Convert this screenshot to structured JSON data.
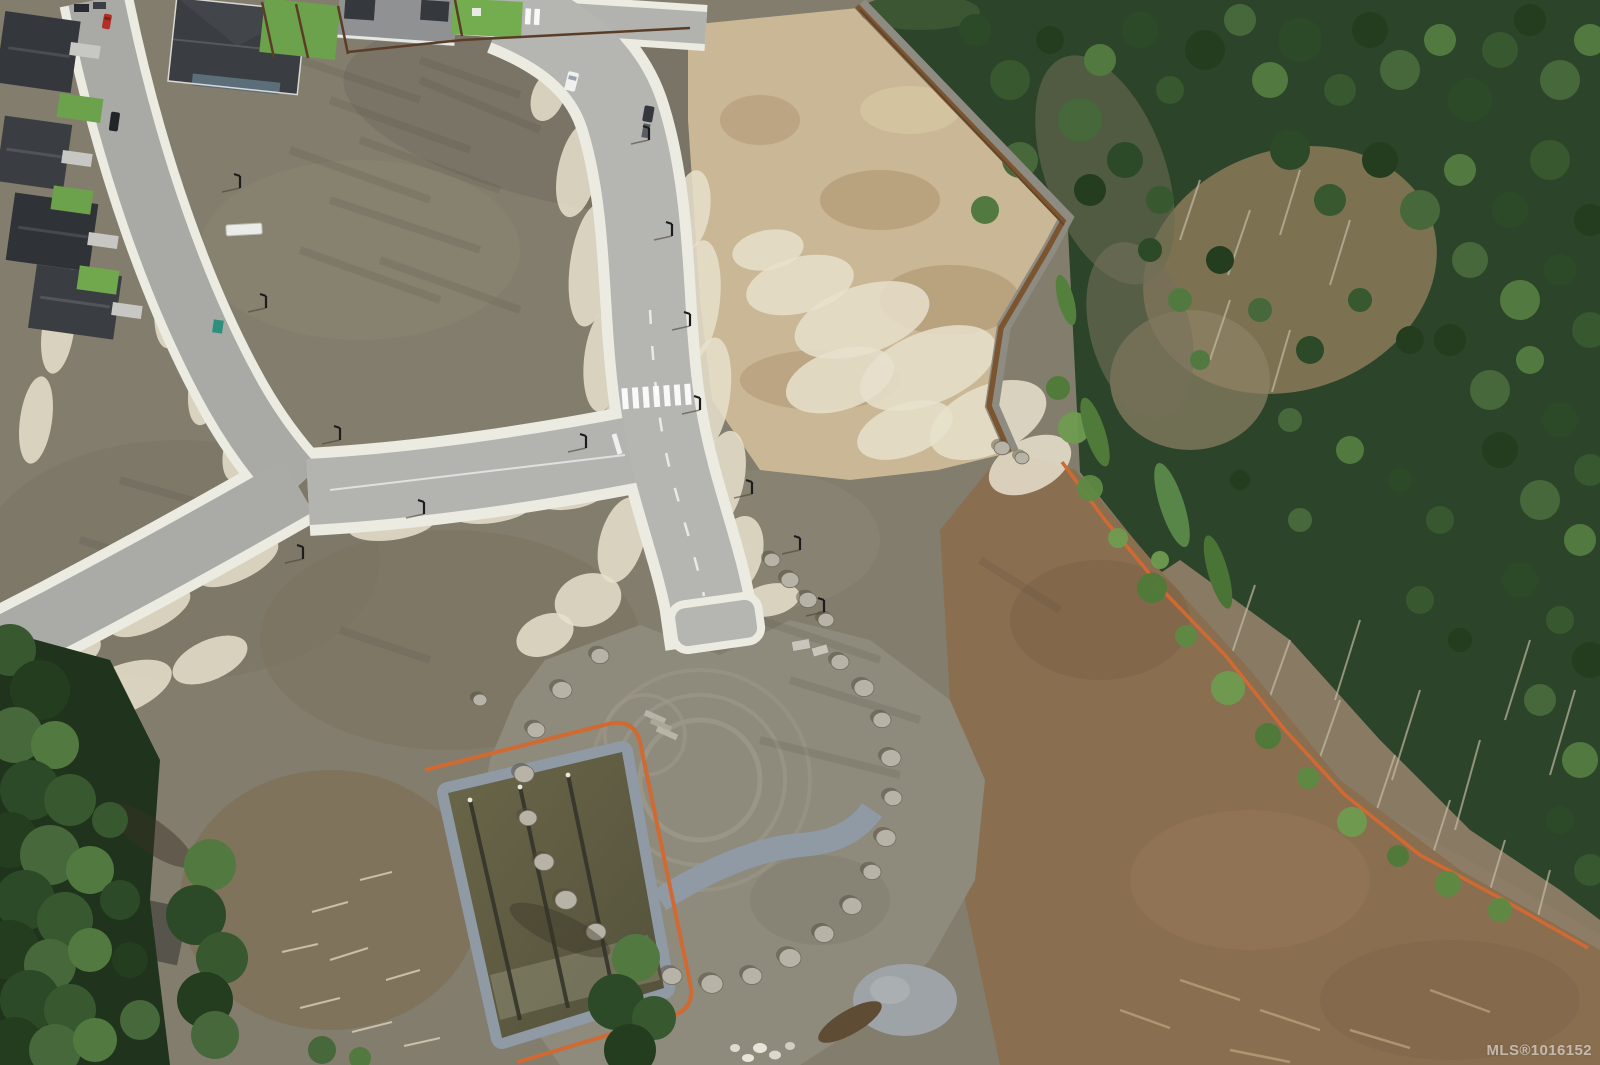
{
  "image": {
    "type": "aerial-drone-photograph",
    "subject": "new residential subdivision under construction beside a forest: graded lots, fresh curbed roads, retention pond, boulder ring, silt fencing",
    "width": 1600,
    "height": 1065
  },
  "watermark": {
    "text": "MLS®1016152"
  },
  "palette": {
    "dirt_olive": "#837d6d",
    "dirt_brown": "#8a6e50",
    "tan_lot": "#c9b795",
    "gravel_white": "#e8e0cd",
    "asphalt_new": "#b5b5b1",
    "asphalt_old": "#a9a9a5",
    "sidewalk": "#ecebe2",
    "forest_green": "#2c452a",
    "tree_green": "#47683a",
    "pond_water": "#5f5c45",
    "riprap_gray": "#8f9aa5",
    "silt_fence_orange": "#cf6a33",
    "retaining_wall_brown": "#7b5530",
    "roof_charcoal": "#3a3d41",
    "lawn_green": "#6da24c",
    "red_car": "#b23026",
    "boulder_gray": "#b7b3a6",
    "pad_gray": "#8e8a7c"
  },
  "features": [
    "existing-neighborhood",
    "new-main-road",
    "t-intersection",
    "crosswalk",
    "cleared-lots",
    "graded-tan-lot",
    "retaining-wall",
    "forest",
    "cleared-slope",
    "silt-fence",
    "gravel-pad",
    "boulder-ring",
    "retention-pond",
    "riprap-channel",
    "mls-watermark"
  ],
  "scenery": {
    "tree_colors": [
      "#2c4a28",
      "#38582f",
      "#243d1f",
      "#47683a",
      "#527a40"
    ],
    "forest_trees": [
      [
        975,
        30,
        16
      ],
      [
        1010,
        80,
        20
      ],
      [
        1050,
        40,
        14
      ],
      [
        1080,
        120,
        22
      ],
      [
        1100,
        60,
        16
      ],
      [
        1140,
        30,
        18
      ],
      [
        1170,
        90,
        14
      ],
      [
        1205,
        50,
        20
      ],
      [
        1240,
        20,
        16
      ],
      [
        1270,
        80,
        18
      ],
      [
        1300,
        40,
        22
      ],
      [
        1340,
        90,
        16
      ],
      [
        1370,
        30,
        18
      ],
      [
        1400,
        70,
        20
      ],
      [
        1440,
        40,
        16
      ],
      [
        1470,
        100,
        22
      ],
      [
        1500,
        50,
        18
      ],
      [
        1530,
        20,
        16
      ],
      [
        1560,
        80,
        20
      ],
      [
        1590,
        40,
        16
      ],
      [
        1125,
        160,
        18
      ],
      [
        1160,
        200,
        14
      ],
      [
        1090,
        190,
        16
      ],
      [
        1020,
        160,
        18
      ],
      [
        985,
        210,
        14
      ],
      [
        1290,
        150,
        20
      ],
      [
        1330,
        200,
        16
      ],
      [
        1380,
        160,
        18
      ],
      [
        1420,
        210,
        20
      ],
      [
        1460,
        170,
        16
      ],
      [
        1510,
        210,
        18
      ],
      [
        1550,
        160,
        20
      ],
      [
        1590,
        220,
        16
      ],
      [
        1470,
        260,
        18
      ],
      [
        1520,
        300,
        20
      ],
      [
        1560,
        270,
        16
      ],
      [
        1590,
        330,
        18
      ],
      [
        1450,
        340,
        16
      ],
      [
        1490,
        390,
        20
      ],
      [
        1530,
        360,
        14
      ],
      [
        1560,
        420,
        18
      ],
      [
        1590,
        470,
        16
      ],
      [
        1500,
        450,
        18
      ],
      [
        1540,
        500,
        20
      ],
      [
        1580,
        540,
        16
      ],
      [
        1520,
        580,
        18
      ],
      [
        1560,
        620,
        14
      ],
      [
        1590,
        660,
        18
      ],
      [
        1540,
        700,
        16
      ],
      [
        1580,
        760,
        18
      ],
      [
        1560,
        820,
        14
      ],
      [
        1590,
        870,
        16
      ],
      [
        1220,
        260,
        14
      ],
      [
        1260,
        310,
        12
      ],
      [
        1200,
        360,
        10
      ],
      [
        1310,
        350,
        14
      ],
      [
        1360,
        300,
        12
      ],
      [
        1410,
        340,
        14
      ],
      [
        1290,
        420,
        12
      ],
      [
        1350,
        450,
        14
      ],
      [
        1400,
        480,
        12
      ],
      [
        1440,
        520,
        14
      ],
      [
        1240,
        480,
        10
      ],
      [
        1300,
        520,
        12
      ],
      [
        1180,
        300,
        12
      ],
      [
        1150,
        250,
        12
      ],
      [
        1420,
        600,
        14
      ],
      [
        1460,
        640,
        12
      ]
    ],
    "sapling_colors": [
      "#5d8a42",
      "#6f9b50",
      "#4e7a39"
    ],
    "saplings": [
      [
        1090,
        488,
        13
      ],
      [
        1118,
        538,
        10
      ],
      [
        1152,
        588,
        15
      ],
      [
        1186,
        636,
        11
      ],
      [
        1228,
        688,
        17
      ],
      [
        1268,
        736,
        13
      ],
      [
        1308,
        778,
        11
      ],
      [
        1352,
        822,
        15
      ],
      [
        1398,
        856,
        11
      ],
      [
        1448,
        884,
        13
      ],
      [
        1074,
        428,
        16
      ],
      [
        1058,
        388,
        12
      ],
      [
        1500,
        910,
        12
      ],
      [
        1160,
        560,
        9
      ]
    ],
    "corner_trees": [
      [
        10,
        650,
        26
      ],
      [
        40,
        690,
        30
      ],
      [
        15,
        735,
        28
      ],
      [
        55,
        745,
        24
      ],
      [
        30,
        790,
        30
      ],
      [
        70,
        800,
        26
      ],
      [
        10,
        840,
        28
      ],
      [
        50,
        855,
        30
      ],
      [
        90,
        870,
        24
      ],
      [
        25,
        900,
        30
      ],
      [
        65,
        920,
        28
      ],
      [
        10,
        950,
        30
      ],
      [
        50,
        965,
        26
      ],
      [
        90,
        950,
        22
      ],
      [
        30,
        1000,
        30
      ],
      [
        70,
        1010,
        26
      ],
      [
        15,
        1045,
        28
      ],
      [
        55,
        1050,
        26
      ],
      [
        95,
        1040,
        22
      ],
      [
        120,
        900,
        20
      ],
      [
        110,
        820,
        18
      ],
      [
        130,
        960,
        18
      ],
      [
        140,
        1020,
        20
      ],
      [
        210,
        865,
        26
      ],
      [
        196,
        915,
        30
      ],
      [
        222,
        958,
        26
      ],
      [
        205,
        1000,
        28
      ],
      [
        215,
        1035,
        24
      ],
      [
        636,
        958,
        24
      ],
      [
        616,
        1002,
        28
      ],
      [
        654,
        1018,
        22
      ],
      [
        630,
        1050,
        26
      ],
      [
        322,
        1050,
        14
      ],
      [
        360,
        1058,
        11
      ]
    ],
    "boulders": [
      [
        600,
        656,
        9
      ],
      [
        562,
        690,
        10
      ],
      [
        536,
        730,
        9
      ],
      [
        524,
        774,
        10
      ],
      [
        528,
        818,
        9
      ],
      [
        544,
        862,
        10
      ],
      [
        566,
        900,
        11
      ],
      [
        596,
        932,
        10
      ],
      [
        632,
        958,
        11
      ],
      [
        672,
        976,
        10
      ],
      [
        712,
        984,
        11
      ],
      [
        752,
        976,
        10
      ],
      [
        790,
        958,
        11
      ],
      [
        824,
        934,
        10
      ],
      [
        852,
        906,
        10
      ],
      [
        872,
        872,
        9
      ],
      [
        886,
        838,
        10
      ],
      [
        893,
        798,
        9
      ],
      [
        891,
        758,
        10
      ],
      [
        882,
        720,
        9
      ],
      [
        864,
        688,
        10
      ],
      [
        840,
        662,
        9
      ],
      [
        772,
        560,
        8
      ],
      [
        790,
        580,
        9
      ],
      [
        808,
        600,
        9
      ],
      [
        826,
        620,
        8
      ],
      [
        1002,
        448,
        8
      ],
      [
        1022,
        458,
        7
      ],
      [
        480,
        700,
        7
      ]
    ],
    "gravel_blobs": [
      [
        578,
        170,
        20,
        48,
        12
      ],
      [
        592,
        265,
        22,
        62,
        8
      ],
      [
        604,
        360,
        20,
        52,
        6
      ],
      [
        612,
        450,
        20,
        50,
        10
      ],
      [
        622,
        540,
        22,
        44,
        16
      ],
      [
        588,
        600,
        34,
        26,
        -18
      ],
      [
        545,
        635,
        30,
        20,
        -24
      ],
      [
        692,
        210,
        18,
        40,
        8
      ],
      [
        698,
        300,
        22,
        60,
        6
      ],
      [
        708,
        395,
        22,
        58,
        8
      ],
      [
        722,
        480,
        22,
        50,
        12
      ],
      [
        738,
        555,
        24,
        40,
        16
      ],
      [
        800,
        285,
        55,
        28,
        -14
      ],
      [
        862,
        320,
        70,
        34,
        -18
      ],
      [
        928,
        368,
        72,
        36,
        -22
      ],
      [
        988,
        420,
        62,
        34,
        -24
      ],
      [
        1030,
        465,
        44,
        26,
        -26
      ],
      [
        768,
        250,
        36,
        20,
        -10
      ],
      [
        905,
        430,
        50,
        26,
        -20
      ],
      [
        840,
        380,
        56,
        30,
        -18
      ],
      [
        152,
        205,
        18,
        46,
        10
      ],
      [
        176,
        295,
        20,
        54,
        10
      ],
      [
        208,
        380,
        18,
        46,
        12
      ],
      [
        240,
        448,
        16,
        34,
        14
      ],
      [
        58,
        330,
        16,
        44,
        8
      ],
      [
        36,
        420,
        16,
        44,
        8
      ],
      [
        76,
        240,
        12,
        30,
        8
      ],
      [
        238,
        562,
        44,
        18,
        -26
      ],
      [
        150,
        612,
        44,
        18,
        -26
      ],
      [
        64,
        658,
        40,
        18,
        -26
      ],
      [
        120,
        690,
        55,
        24,
        -22
      ],
      [
        210,
        660,
        40,
        20,
        -24
      ],
      [
        30,
        716,
        34,
        22,
        -20
      ],
      [
        432,
        462,
        44,
        14,
        -6
      ],
      [
        528,
        448,
        40,
        13,
        -8
      ],
      [
        392,
        524,
        44,
        16,
        -8
      ],
      [
        492,
        508,
        42,
        15,
        -8
      ],
      [
        572,
        496,
        34,
        13,
        -10
      ],
      [
        770,
        600,
        30,
        16,
        -12
      ],
      [
        548,
        96,
        16,
        26,
        20
      ]
    ],
    "dirt_streaks": [
      [
        300,
        60,
        420,
        100
      ],
      [
        330,
        100,
        470,
        150
      ],
      [
        290,
        150,
        430,
        200
      ],
      [
        330,
        200,
        480,
        250
      ],
      [
        300,
        250,
        440,
        300
      ],
      [
        360,
        140,
        500,
        190
      ],
      [
        380,
        260,
        520,
        310
      ],
      [
        420,
        80,
        540,
        130
      ],
      [
        120,
        480,
        260,
        520
      ],
      [
        80,
        540,
        200,
        575
      ],
      [
        760,
        620,
        880,
        660
      ],
      [
        790,
        680,
        920,
        720
      ],
      [
        760,
        740,
        900,
        775
      ],
      [
        980,
        560,
        1060,
        610
      ],
      [
        340,
        630,
        430,
        660
      ],
      [
        420,
        60,
        520,
        95
      ]
    ],
    "dead_logs": [
      [
        1290,
        640,
        1258,
        730
      ],
      [
        1340,
        700,
        1305,
        800
      ],
      [
        1395,
        755,
        1360,
        860
      ],
      [
        1450,
        800,
        1415,
        910
      ],
      [
        1505,
        840,
        1472,
        950
      ],
      [
        1550,
        870,
        1520,
        985
      ],
      [
        1255,
        585,
        1228,
        665
      ],
      [
        1420,
        690,
        1392,
        780
      ],
      [
        1480,
        740,
        1455,
        830
      ],
      [
        1530,
        640,
        1505,
        720
      ],
      [
        1575,
        690,
        1550,
        775
      ],
      [
        1360,
        620,
        1335,
        700
      ],
      [
        1200,
        180,
        1180,
        240
      ],
      [
        1250,
        210,
        1228,
        275
      ],
      [
        1300,
        170,
        1280,
        235
      ],
      [
        1350,
        220,
        1330,
        285
      ],
      [
        1230,
        300,
        1210,
        360
      ],
      [
        1290,
        330,
        1272,
        392
      ]
    ],
    "debris_light": [
      [
        312,
        912,
        348,
        902
      ],
      [
        330,
        960,
        368,
        948
      ],
      [
        300,
        1008,
        340,
        998
      ],
      [
        352,
        1032,
        392,
        1022
      ],
      [
        386,
        980,
        420,
        970
      ],
      [
        282,
        952,
        318,
        944
      ],
      [
        360,
        880,
        392,
        872
      ],
      [
        404,
        1046,
        440,
        1038
      ]
    ],
    "debris_brown": [
      [
        1180,
        980,
        1240,
        1000
      ],
      [
        1260,
        1010,
        1320,
        1030
      ],
      [
        1350,
        1030,
        1410,
        1048
      ],
      [
        1430,
        990,
        1490,
        1012
      ],
      [
        1230,
        1050,
        1290,
        1062
      ],
      [
        1120,
        1010,
        1170,
        1028
      ]
    ]
  }
}
